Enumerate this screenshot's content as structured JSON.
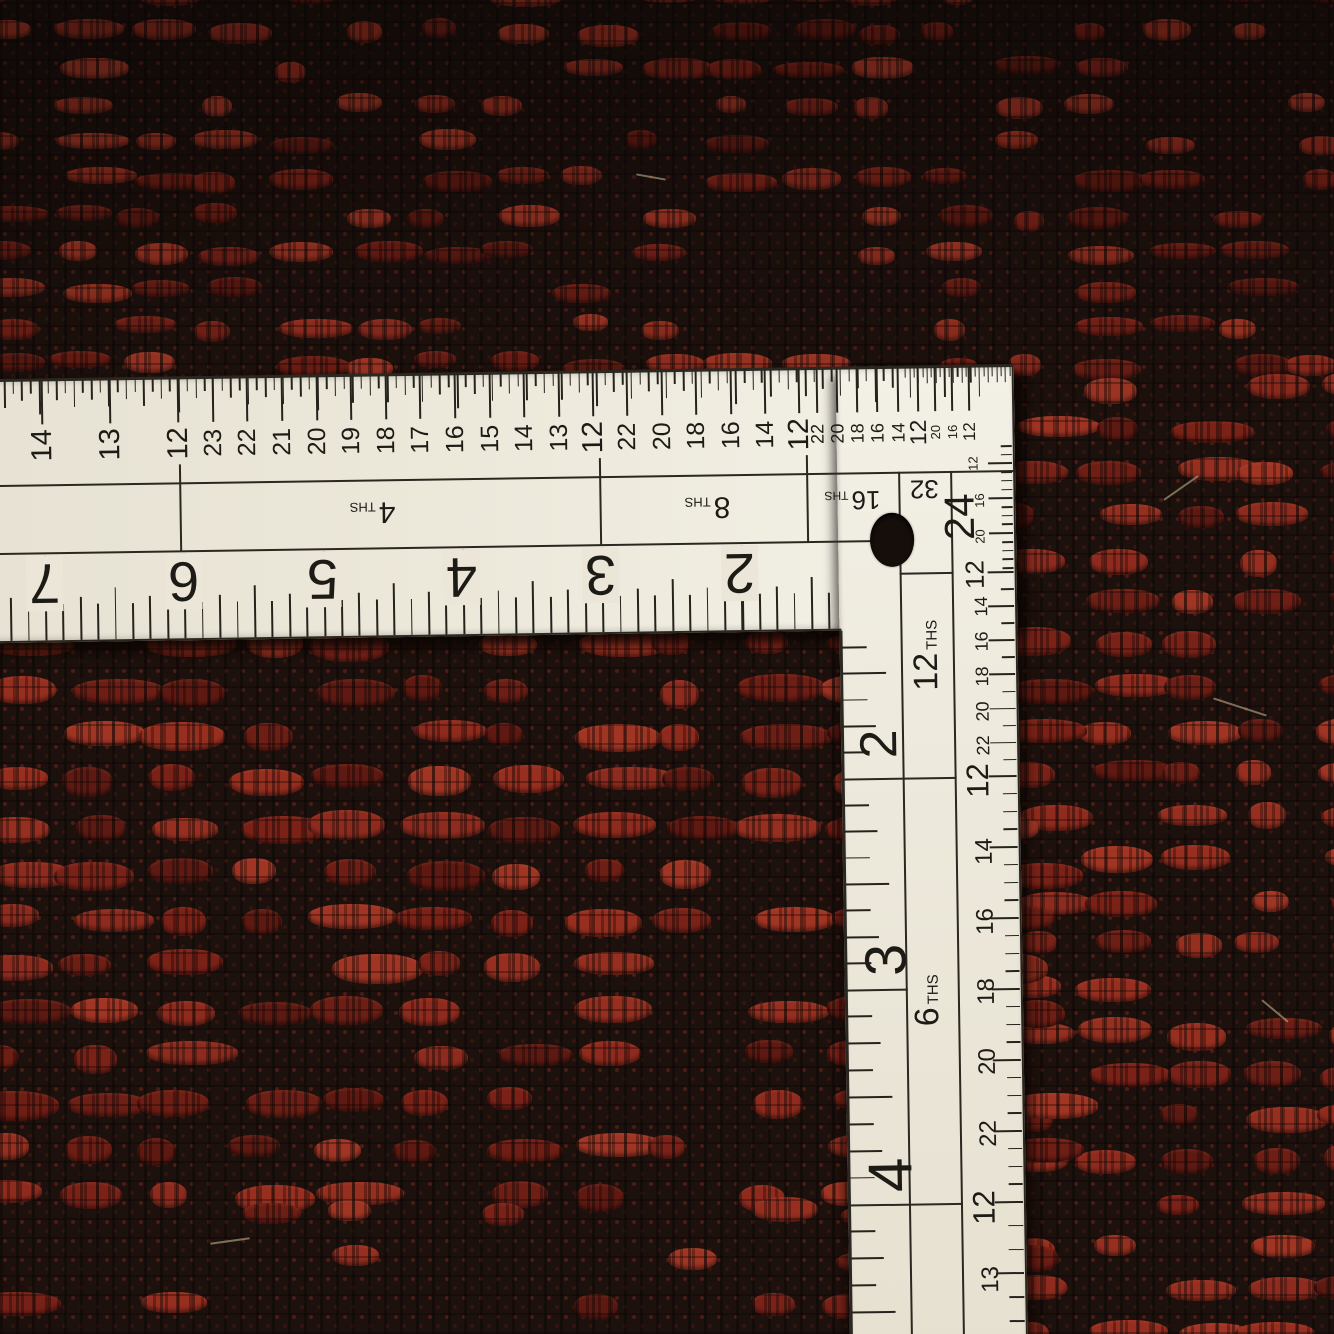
{
  "colors": {
    "ruler_paper": "#ece8da",
    "ruler_ink": "#1d1b16",
    "carpet_red": "#8e2b1e",
    "carpet_black": "#1d110d"
  },
  "ruler": {
    "horizontal_arm": {
      "top_scale": {
        "sections": [
          {
            "name": "halves",
            "numbers": [
              "14",
              "13",
              "12"
            ]
          },
          {
            "name": "fourths",
            "numbers": [
              "23",
              "22",
              "21",
              "20",
              "19",
              "18",
              "17",
              "16",
              "15",
              "14",
              "13",
              "12"
            ]
          },
          {
            "name": "eighths",
            "numbers": [
              "22",
              "20",
              "18",
              "16",
              "14",
              "12"
            ]
          },
          {
            "name": "sixteenths",
            "numbers": [
              "22",
              "20",
              "18",
              "16",
              "14",
              "12"
            ]
          },
          {
            "name": "thirtyseconds",
            "numbers": [
              "20",
              "16",
              "12"
            ]
          }
        ]
      },
      "denominator_labels": [
        {
          "value": "4",
          "suffix": "THS"
        },
        {
          "value": "8",
          "suffix": "THS"
        },
        {
          "value": "16",
          "suffix": "THS"
        },
        {
          "value": "32",
          "suffix": ""
        }
      ],
      "inch_numbers": [
        "7",
        "6",
        "5",
        "4",
        "3",
        "2"
      ]
    },
    "vertical_arm": {
      "corner_denominator": "24",
      "denominator_labels": [
        {
          "value": "12",
          "suffix": "THS"
        },
        {
          "value": "6",
          "suffix": "THS"
        }
      ],
      "inch_numbers": [
        "2",
        "3",
        "4"
      ],
      "outer_scale": {
        "sections": [
          {
            "name": "twentyfourths",
            "numbers": [
              "12",
              "16",
              "20"
            ]
          },
          {
            "name": "twelfths",
            "numbers": [
              "12",
              "14",
              "16",
              "18",
              "20",
              "22"
            ]
          },
          {
            "name": "sixths",
            "numbers": [
              "12",
              "14",
              "16",
              "18",
              "20",
              "22"
            ]
          },
          {
            "name": "thirds",
            "numbers": [
              "12",
              "13"
            ]
          }
        ]
      }
    }
  }
}
